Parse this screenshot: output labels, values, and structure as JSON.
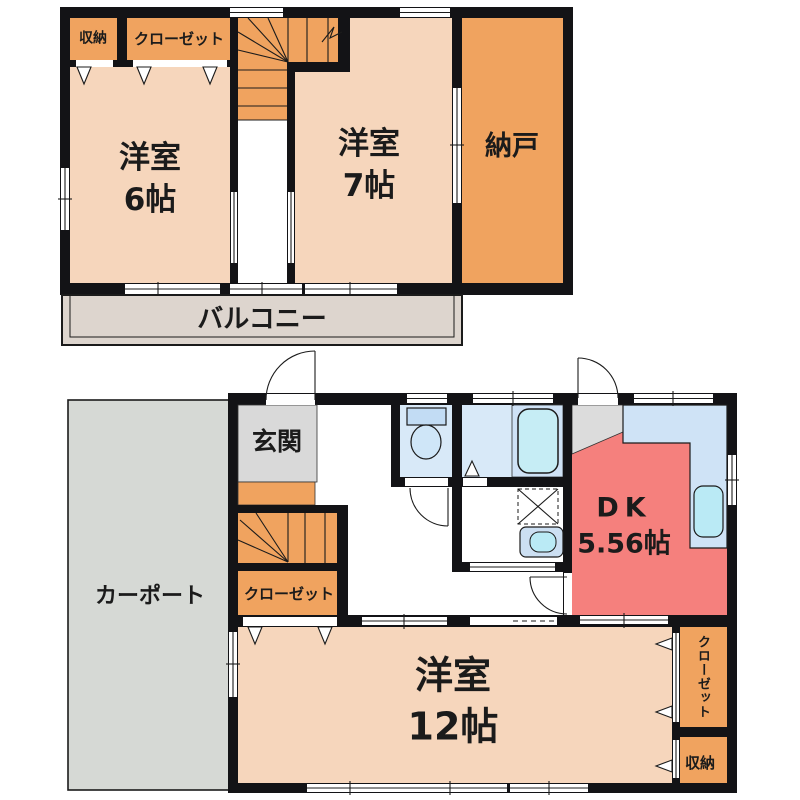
{
  "floor2": {
    "storage": "収納",
    "closet": "クローゼット",
    "bedroom6": {
      "name": "洋室",
      "size": "6帖"
    },
    "bedroom7": {
      "name": "洋室",
      "size": "7帖"
    },
    "nando": "納戸",
    "balcony": "バルコニー"
  },
  "floor1": {
    "entrance": "玄関",
    "carport": "カーポート",
    "closet_hall": "クローゼット",
    "bedroom12": {
      "name": "洋室",
      "size": "12帖"
    },
    "dk": {
      "name": "DK",
      "size": "5.56帖"
    },
    "closet_right": "クローゼット",
    "storage": "収納"
  },
  "colors": {
    "wall": "#131316",
    "room_peach": "#f6d6bc",
    "closet_orange": "#f0a35f",
    "balcony_gray": "#ddd5ce",
    "carport_gray": "#d6d9d5",
    "entrance_gray": "#d9d9d9",
    "water_blue": "#d8e9f8",
    "bath_blue": "#cfe2f6",
    "tub_cyan": "#c6edf5",
    "dk_red": "#f5807d",
    "counter_blue": "#cfe3f6",
    "fridge_gray": "#dcdcdc"
  }
}
